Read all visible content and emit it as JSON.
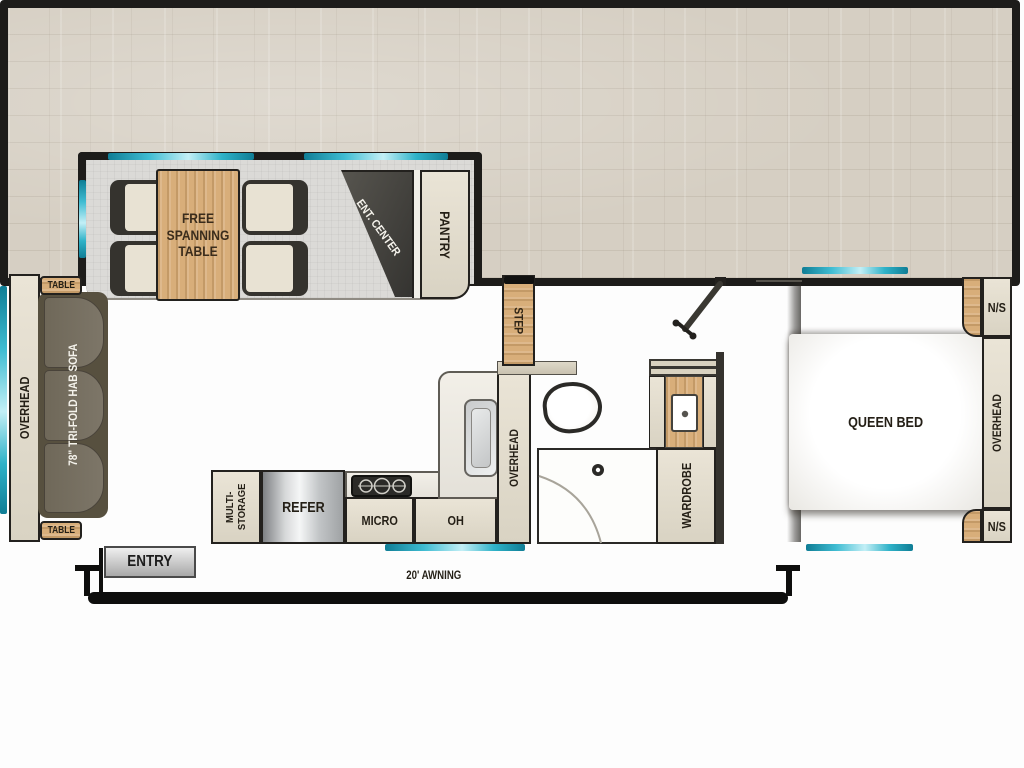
{
  "slide": {
    "table_label": "FREE SPANNING TABLE",
    "ent_center_label": "ENT. CENTER",
    "pantry_label": "PANTRY"
  },
  "living": {
    "overhead_label": "OVERHEAD",
    "sofa_label": "78\" TRI-FOLD HAB SOFA",
    "table_top_label": "TABLE",
    "table_bottom_label": "TABLE"
  },
  "kitchen": {
    "multi_storage_line1": "MULTI-",
    "multi_storage_line2": "STORAGE",
    "refer_label": "REFER",
    "micro_label": "MICRO",
    "oh_label": "OH",
    "overhead_label": "OVERHEAD",
    "step_label": "STEP"
  },
  "bath": {
    "wardrobe_label": "WARDROBE"
  },
  "bedroom": {
    "bed_label": "QUEEN BED",
    "ns_top_label": "N/S",
    "ns_bottom_label": "N/S",
    "overhead_label": "OVERHEAD"
  },
  "exterior": {
    "entry_label": "ENTRY",
    "awning_label": "20' AWNING"
  },
  "colors": {
    "wall_black": "#1d1c1a",
    "window_teal": "#3fbcd2",
    "floor_main": "#d6cfc3",
    "floor_slide": "#dbdad7",
    "cabinet_beige": "#e3ddcf",
    "wood": "#d8ae7a",
    "sofa_dark": "#6f6859",
    "ent_center_dark": "#44423d",
    "refer_silver": "#d7d9da"
  }
}
